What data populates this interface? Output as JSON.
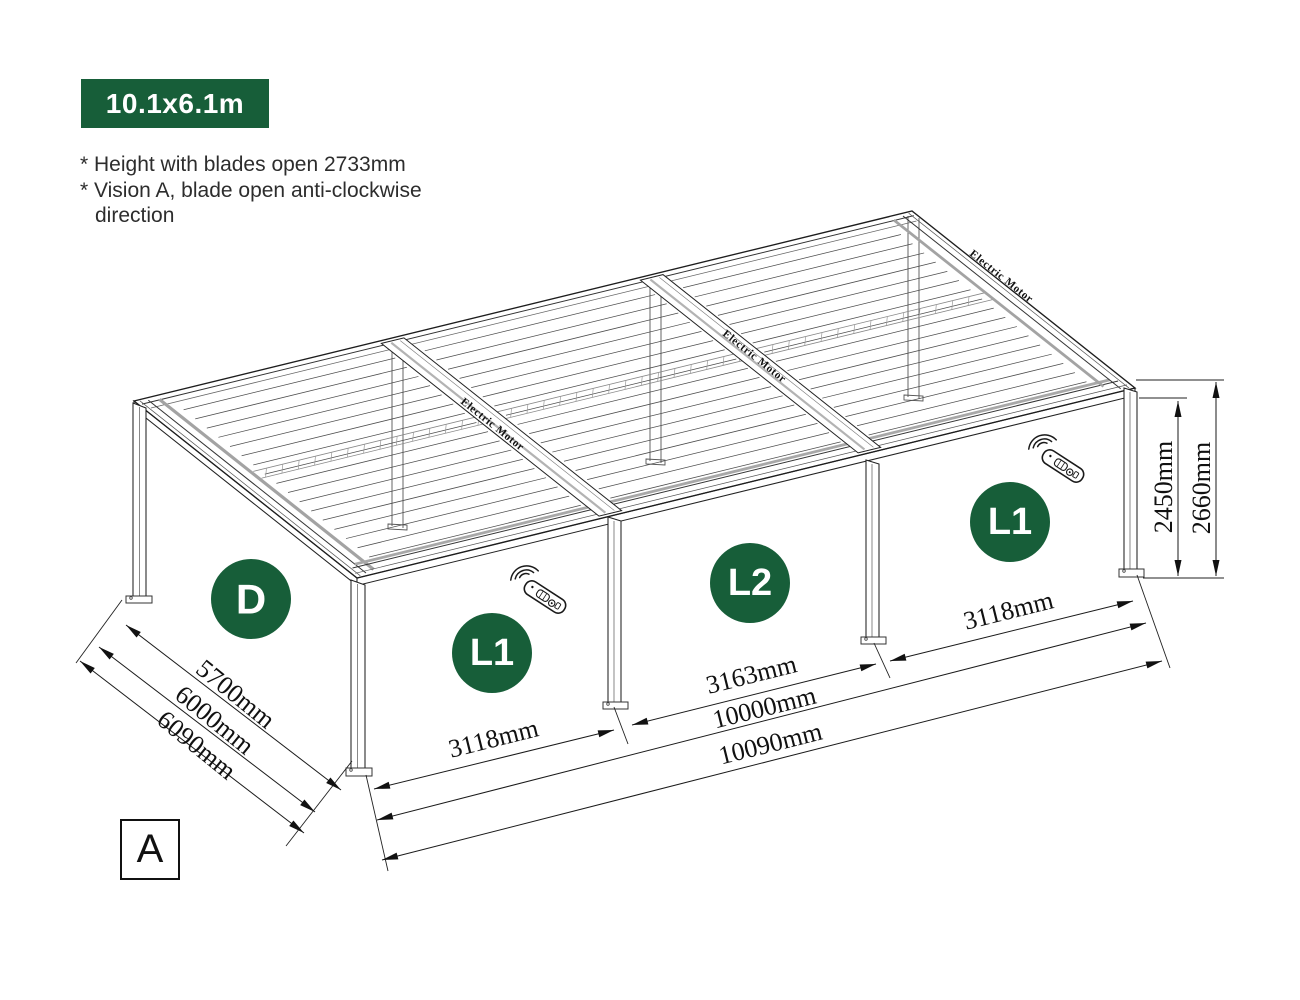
{
  "badge": {
    "label": "10.1x6.1m"
  },
  "notes": [
    "* Height with blades open 2733mm",
    "* Vision A, blade open anti-clockwise",
    "direction"
  ],
  "view_label": "A",
  "zones": [
    {
      "id": "D"
    },
    {
      "id": "L1"
    },
    {
      "id": "L2"
    },
    {
      "id": "L1"
    }
  ],
  "motor_labels": [
    "Electric Motor",
    "Electric Motor",
    "Electric Motor"
  ],
  "dimensions": {
    "left": [
      "5700mm",
      "6000mm",
      "6090mm"
    ],
    "bottom": [
      "3118mm",
      "3163mm",
      "3118mm",
      "10000mm",
      "10090mm"
    ],
    "right": [
      "2450mm",
      "2660mm"
    ]
  },
  "colors": {
    "accent_green": "#175E39",
    "line": "#1d1d1d"
  }
}
